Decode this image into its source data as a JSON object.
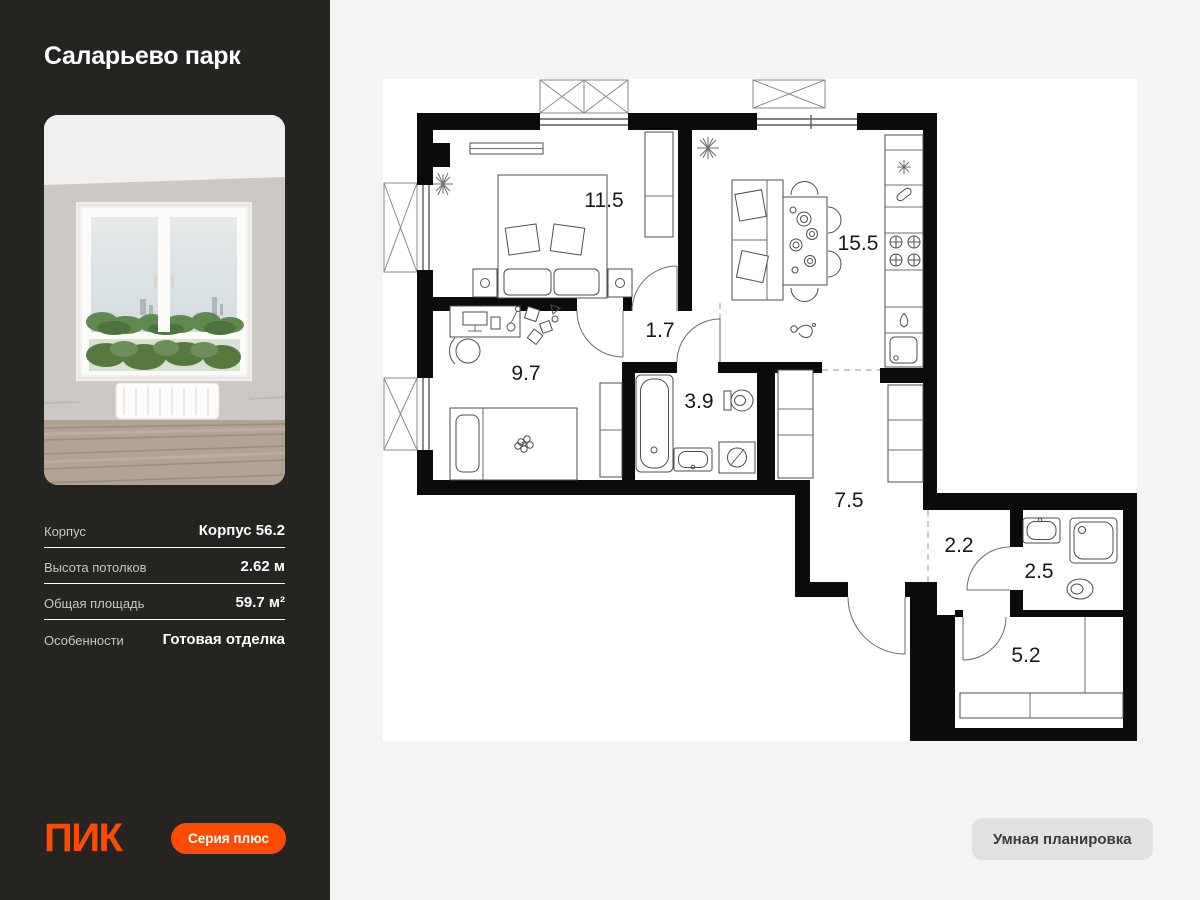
{
  "sidebar": {
    "project_title": "Саларьево парк",
    "details": [
      {
        "label": "Корпус",
        "value": "Корпус 56.2"
      },
      {
        "label": "Высота потолков",
        "value": "2.62 м"
      },
      {
        "label": "Общая площадь",
        "value": "59.7 м²"
      },
      {
        "label": "Особенности",
        "value": "Готовая отделка"
      }
    ],
    "logo_text": "ПИК",
    "series_button_label": "Серия плюс"
  },
  "plan": {
    "rooms": [
      {
        "name": "bedroom",
        "area": "11.5"
      },
      {
        "name": "kitchen-living",
        "area": "15.5"
      },
      {
        "name": "hallway",
        "area": "1.7"
      },
      {
        "name": "kids-room",
        "area": "9.7"
      },
      {
        "name": "bathroom",
        "area": "3.9"
      },
      {
        "name": "corridor",
        "area": "7.5"
      },
      {
        "name": "entry-hall",
        "area": "2.2"
      },
      {
        "name": "shower-room",
        "area": "2.5"
      },
      {
        "name": "wardrobe",
        "area": "5.2"
      }
    ]
  },
  "footer": {
    "smart_layout_button_label": "Умная планировка"
  },
  "colors": {
    "accent_orange": "#FC4C02",
    "sidebar_bg": "#252421",
    "page_bg": "#F5F4F2",
    "plan_bg": "#FFFFFF",
    "walls": "#0B0B0B",
    "smart_button_bg": "#E2E1DF"
  }
}
